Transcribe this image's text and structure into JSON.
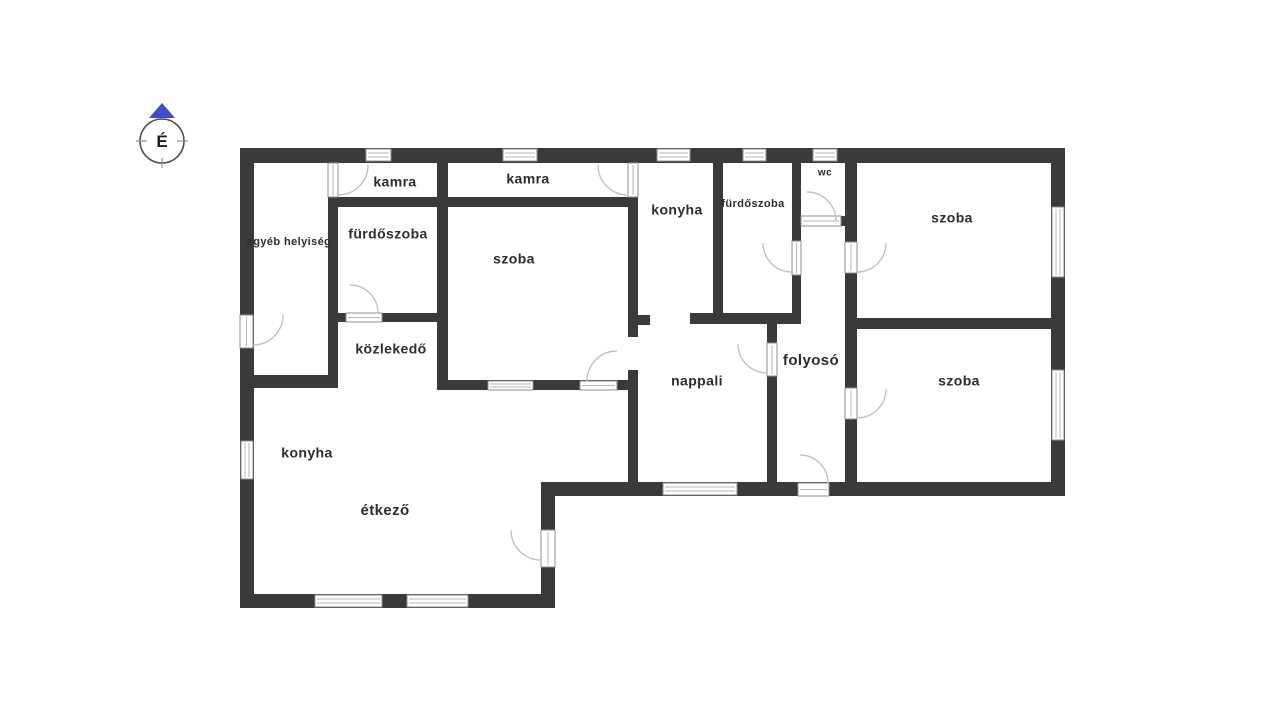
{
  "compass": {
    "label": "É",
    "arrow_color": "#3a4ec8",
    "ring_color": "#4f4f4f"
  },
  "colors": {
    "background": "#ffffff",
    "wall": "#3a3a3a",
    "opening_fill": "#ffffff",
    "opening_stroke": "#8f8f8f",
    "opening_lines": "#b5b5b5",
    "door_arc": "#c2c2c2",
    "label_text": "#2d2d2d"
  },
  "rooms": [
    {
      "label": "kamra",
      "x": 395,
      "y": 183,
      "size": 14
    },
    {
      "label": "kamra",
      "x": 528,
      "y": 180,
      "size": 14
    },
    {
      "label": "fürdőszoba",
      "x": 388,
      "y": 235,
      "size": 14
    },
    {
      "label": "egyéb helyiség",
      "x": 289,
      "y": 242,
      "size": 11
    },
    {
      "label": "szoba",
      "x": 514,
      "y": 260,
      "size": 14
    },
    {
      "label": "konyha",
      "x": 677,
      "y": 211,
      "size": 14
    },
    {
      "label": "fürdőszoba",
      "x": 753,
      "y": 204,
      "size": 11
    },
    {
      "label": "wc",
      "x": 825,
      "y": 173,
      "size": 10
    },
    {
      "label": "szoba",
      "x": 952,
      "y": 219,
      "size": 14
    },
    {
      "label": "közlekedő",
      "x": 391,
      "y": 350,
      "size": 14
    },
    {
      "label": "nappali",
      "x": 697,
      "y": 382,
      "size": 14
    },
    {
      "label": "folyosó",
      "x": 811,
      "y": 361,
      "size": 15
    },
    {
      "label": "szoba",
      "x": 959,
      "y": 382,
      "size": 14
    },
    {
      "label": "konyha",
      "x": 307,
      "y": 454,
      "size": 14
    },
    {
      "label": "étkező",
      "x": 385,
      "y": 511,
      "size": 15
    }
  ],
  "plan": {
    "walls": [
      [
        240,
        148,
        825,
        15
      ],
      [
        240,
        148,
        14,
        460
      ],
      [
        240,
        594,
        315,
        14
      ],
      [
        541,
        482,
        14,
        126
      ],
      [
        541,
        482,
        524,
        14
      ],
      [
        1051,
        148,
        14,
        348
      ],
      [
        328,
        197,
        10,
        191
      ],
      [
        437,
        163,
        11,
        225
      ],
      [
        628,
        197,
        10,
        140
      ],
      [
        628,
        370,
        10,
        126
      ],
      [
        713,
        163,
        10,
        161
      ],
      [
        792,
        163,
        9,
        78
      ],
      [
        792,
        275,
        9,
        49
      ],
      [
        845,
        163,
        12,
        79
      ],
      [
        845,
        273,
        12,
        115
      ],
      [
        845,
        418,
        12,
        78
      ],
      [
        767,
        313,
        10,
        30
      ],
      [
        767,
        376,
        10,
        120
      ],
      [
        328,
        197,
        310,
        10
      ],
      [
        328,
        313,
        120,
        9
      ],
      [
        240,
        375,
        98,
        13
      ],
      [
        437,
        380,
        201,
        10
      ],
      [
        628,
        315,
        22,
        10
      ],
      [
        690,
        313,
        111,
        11
      ],
      [
        796,
        216,
        61,
        10
      ],
      [
        845,
        318,
        220,
        11
      ]
    ],
    "windows": [
      [
        366,
        149,
        25,
        12
      ],
      [
        503,
        149,
        34,
        12
      ],
      [
        657,
        149,
        33,
        12
      ],
      [
        743,
        149,
        23,
        12
      ],
      [
        813,
        149,
        24,
        12
      ],
      [
        1052,
        207,
        12,
        70
      ],
      [
        1052,
        370,
        12,
        70
      ],
      [
        241,
        441,
        12,
        38
      ],
      [
        315,
        595,
        67,
        12
      ],
      [
        407,
        595,
        61,
        12
      ],
      [
        663,
        483,
        74,
        12
      ],
      [
        488,
        381,
        45,
        9
      ]
    ],
    "doors": [
      {
        "leaf": [
          240,
          315,
          13,
          33
        ],
        "arc": "M 283 315 A 30 30 0 0 1 253 345"
      },
      {
        "leaf": [
          328,
          163,
          10,
          34
        ],
        "arc": "M 368 165 A 30 30 0 0 1 338 195"
      },
      {
        "leaf": [
          628,
          163,
          10,
          34
        ],
        "arc": "M 598 165 A 30 30 0 0 0 628 195"
      },
      {
        "leaf": [
          346,
          313,
          36,
          9
        ],
        "arc": "M 350 285 A 28 28 0 0 1 378 313"
      },
      {
        "leaf": [
          580,
          381,
          37,
          9
        ],
        "arc": "M 617 351 A 30 30 0 0 0 587 381"
      },
      {
        "leaf": [
          801,
          216,
          40,
          10
        ],
        "arc": "M 807 192 A 29 29 0 0 1 836 221"
      },
      {
        "leaf": [
          792,
          241,
          9,
          34
        ],
        "arc": "M 763 243 A 29 29 0 0 0 792 272"
      },
      {
        "leaf": [
          845,
          242,
          12,
          31
        ],
        "arc": "M 886 243 A 29 29 0 0 1 857 272"
      },
      {
        "leaf": [
          845,
          388,
          12,
          31
        ],
        "arc": "M 886 389 A 29 29 0 0 1 857 418"
      },
      {
        "leaf": [
          767,
          343,
          10,
          33
        ],
        "arc": "M 738 344 A 29 29 0 0 0 767 373"
      },
      {
        "leaf": [
          798,
          483,
          31,
          13
        ],
        "arc": "M 800 455 A 28 28 0 0 1 828 483"
      },
      {
        "leaf": [
          541,
          530,
          14,
          37
        ],
        "arc": "M 511 530 A 30 30 0 0 0 541 560"
      }
    ]
  }
}
